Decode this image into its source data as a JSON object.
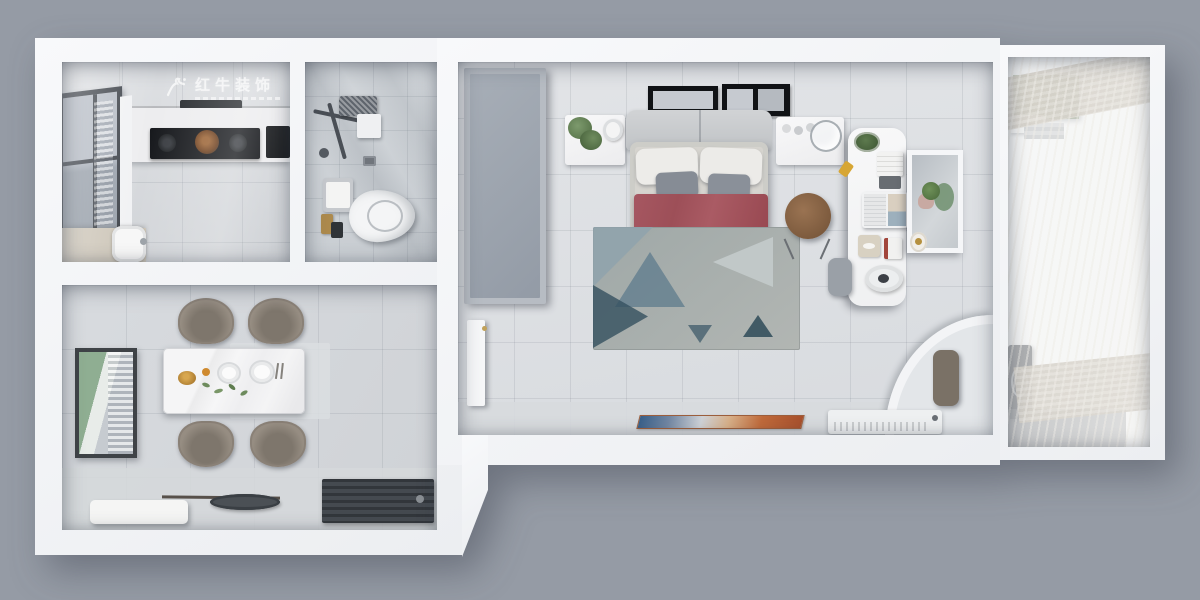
{
  "watermark": {
    "text": "红牛装饰",
    "logo": "bull-swoosh-icon",
    "color": "#ffffff",
    "subtext_present": true
  },
  "palette": {
    "background": "#959ba5",
    "wall": "#f5f6f8",
    "bedroom_floor": "#dcdfe3",
    "bathroom_floor": "#ced2d7",
    "kitchen_floor": "#d8dbdf",
    "bed_blanket_red": "#a25059",
    "bed_duvet": "#dedbd3",
    "gray_pillow": "#868c95",
    "rug_base": "#a7aeac",
    "rug_accent_blue": "#35505f",
    "stool_wood": "#8a6547",
    "balcony_cabinet_green": "#8d9a80",
    "curtain_khaki": "#a29a8a",
    "marble_table": "#f4f4f5",
    "doormat_dark": "#3e4349",
    "entry_mat_blue": "#39608a",
    "entry_mat_orange": "#c06a3a",
    "cooktop_black": "#17191d",
    "washing_machine": "#4b4f54"
  },
  "scene": {
    "type": "top-down 3D apartment floor plan render",
    "rooms": [
      {
        "name": "kitchen",
        "items": [
          "upper-cabinets",
          "range-hood",
          "gas-cooktop",
          "window",
          "counter",
          "sink"
        ]
      },
      {
        "name": "bathroom",
        "items": [
          "shower-set",
          "shower-shelf",
          "floor-drain",
          "toilet",
          "towel",
          "toiletries-caddy"
        ]
      },
      {
        "name": "dining-room",
        "items": [
          "wall-art",
          "marble-dining-table",
          "dining-chairs-x4",
          "gold-fruit-bowl",
          "plates",
          "chopsticks",
          "garnish",
          "floor-runner",
          "bench",
          "floor-tray",
          "doormat"
        ]
      },
      {
        "name": "bedroom",
        "items": [
          "wardrobe",
          "entry-door",
          "picture-frames-x2",
          "nightstand-left",
          "potted-plant",
          "round-lamp",
          "headboard",
          "double-bed",
          "pillows",
          "gray-accent-pillows",
          "red-blanket",
          "duvet",
          "geometric-area-rug",
          "round-wood-stool",
          "desk",
          "desk-plant",
          "book-stack",
          "notebook",
          "laptop",
          "tissue-box",
          "desk-lamp",
          "desk-chair",
          "wall-mirror",
          "vanity-plant",
          "gold-tray",
          "curved-partition",
          "niche-stool",
          "air-conditioner",
          "colorful-entry-mat"
        ]
      },
      {
        "name": "balcony",
        "items": [
          "green-cabinet",
          "wall-shelf",
          "washing-machine",
          "sheer-curtains",
          "khaki-curtain-bands"
        ]
      }
    ]
  }
}
